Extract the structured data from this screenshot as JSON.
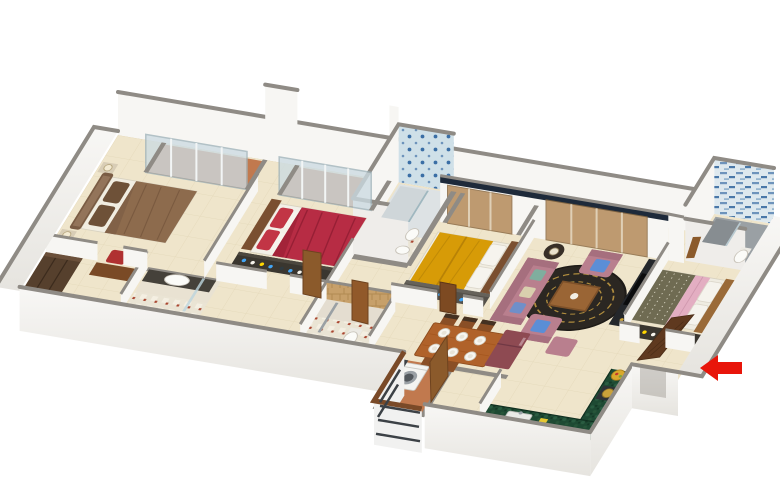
{
  "scene": {
    "type": "3d-isometric-floor-plan-render",
    "background": "#ffffff",
    "entrance_arrow": {
      "direction": "left",
      "color": "#e8150a"
    },
    "rooms": [
      {
        "id": "master-bedroom",
        "key_items": [
          "brown-double-bed",
          "tall-headboard",
          "dark-wardrobe",
          "desk",
          "red-chair",
          "bedside-lamps"
        ]
      },
      {
        "id": "bedroom-2",
        "key_items": [
          "red-striped-bed",
          "red-pillows",
          "dresser-with-bottles",
          "balcony-sliding-door"
        ]
      },
      {
        "id": "bedroom-3",
        "key_items": [
          "yellow-double-bed",
          "white-pillows",
          "dresser-with-bottles",
          "tinted-glass-door"
        ]
      },
      {
        "id": "bedroom-4",
        "key_items": [
          "olive-green-bed",
          "pink-blanket",
          "open-wood-door",
          "dresser-with-bottles"
        ]
      },
      {
        "id": "living-room",
        "key_items": [
          "mauve-sofa",
          "two-armchairs",
          "blue-cushions",
          "round-dark-rug",
          "wood-coffee-table",
          "tv-unit"
        ]
      },
      {
        "id": "dining-area",
        "key_items": [
          "wood-table",
          "six-plates",
          "five-chairs"
        ]
      },
      {
        "id": "kitchen",
        "key_items": [
          "green-granite-l-counter",
          "sink",
          "stove",
          "fruit-bowl",
          "maroon-fridge"
        ]
      },
      {
        "id": "utility-balcony",
        "key_items": [
          "washing-machine",
          "railing",
          "terracotta-floor"
        ]
      },
      {
        "id": "bathroom-ensuite",
        "key_items": [
          "oval-basin",
          "dark-counter",
          "shower-glass"
        ]
      },
      {
        "id": "bathroom-blue-tower",
        "key_items": [
          "blue-pattern-tiles",
          "shower",
          "toilet"
        ]
      },
      {
        "id": "bathroom-stone",
        "key_items": [
          "tan-stone-tiles",
          "shower-partition",
          "toilet"
        ]
      },
      {
        "id": "bathroom-top-right",
        "key_items": [
          "blue-mosaic-strip-wall",
          "grey-shower",
          "toilet",
          "checker-floor"
        ]
      },
      {
        "id": "balcony-1"
      },
      {
        "id": "balcony-2"
      },
      {
        "id": "balcony-3"
      },
      {
        "id": "entrance-foyer",
        "key_items": [
          "open-entry-door",
          "red-direction-arrow"
        ]
      }
    ]
  },
  "colors": {
    "wall_top": "#8f8b85",
    "wall_face": "#f7f6f3",
    "floor_main": "#efe5cb",
    "floor_balcony": "#c1794e",
    "glass_pale": "#ccdbe2",
    "glass_brown": "#b58a5a",
    "window_band_dark": "#1e2a3a",
    "bed1_duvet": "#8d6b4d",
    "bed1_headboard": "#7a5c44",
    "bed2_duvet": "#b72c44",
    "bed2_pillow": "#c23545",
    "bed3_duvet": "#d79b07",
    "bed4_duvet": "#6f6b52",
    "bed4_blanket": "#e3aec2",
    "sofa_mauve": "#b97f8e",
    "cushion_blue": "#5b8ed6",
    "rug_dark": "#2b2722",
    "rug_gold": "#b08d3e",
    "dining_wood": "#b0622a",
    "chair_wood": "#8a4f26",
    "door_wood": "#8b5a2b",
    "entry_door_wood": "#5f391f",
    "wardrobe_wood": "#56402d",
    "dresser_dark": "#3a362f",
    "kitchen_green": "#1e4a33",
    "fridge_maroon": "#8e4a52",
    "washer_white": "#f4f4f1",
    "arrow_red": "#e8150a"
  }
}
